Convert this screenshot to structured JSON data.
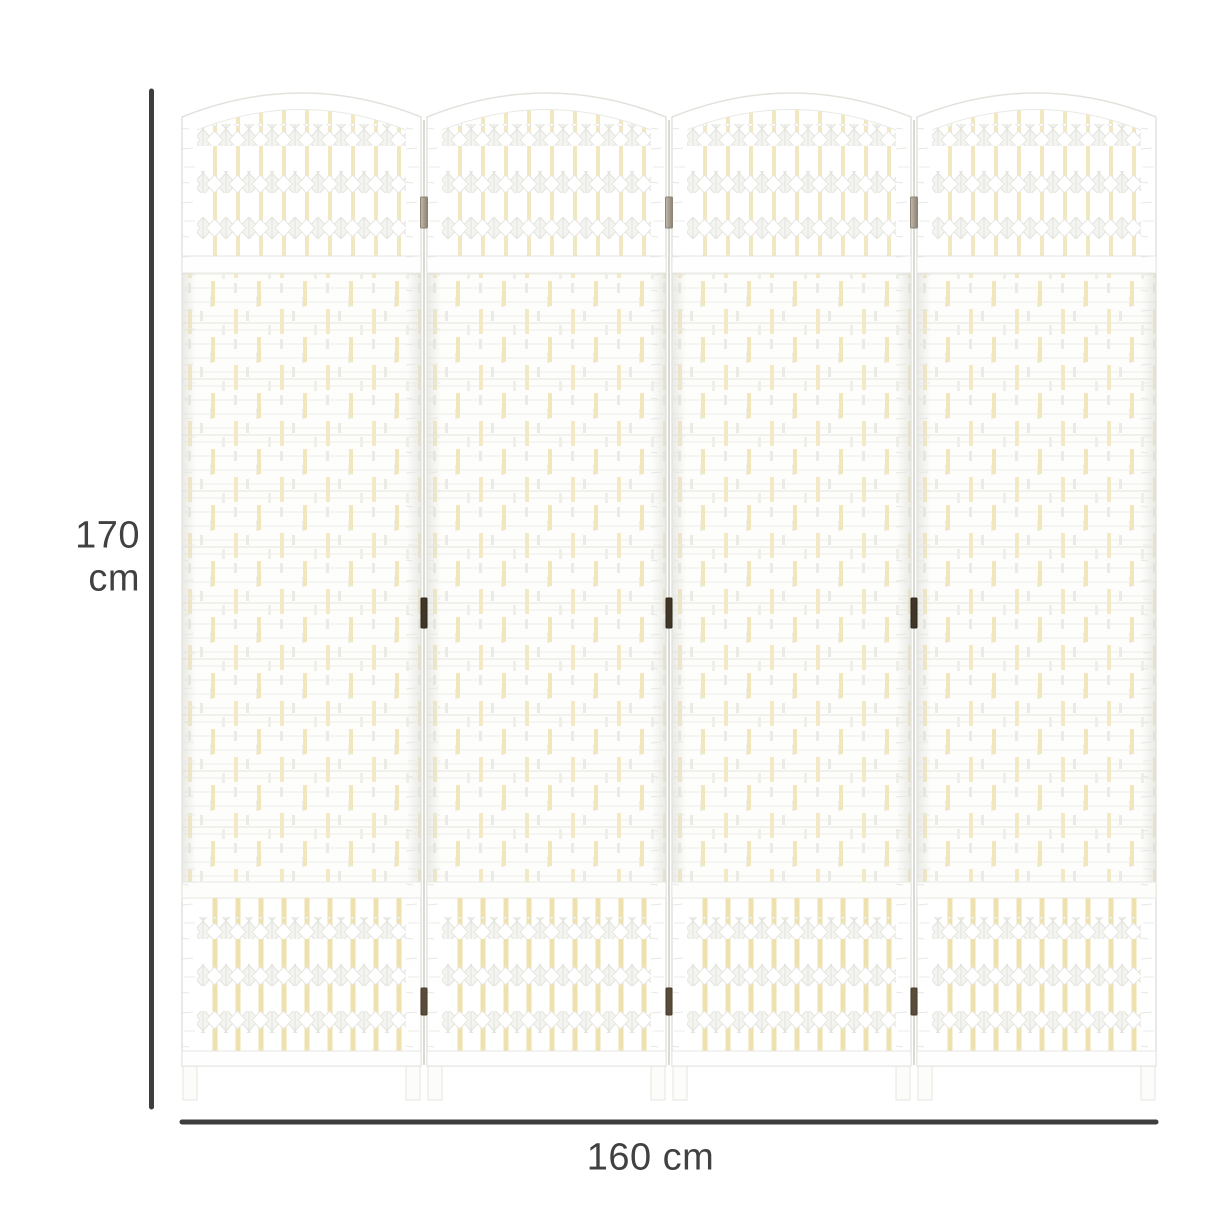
{
  "figure": {
    "description": "Four-panel wave-fiber folding room divider shown with overall dimension lines",
    "dimensions": {
      "height": "170 cm",
      "width": "160 cm"
    },
    "divider": {
      "panel_count": 4,
      "knot_rows_per_lattice": 3,
      "hinge_rows": 3
    },
    "colors": {
      "background": "#ffffff",
      "panel_white": "#ffffff",
      "weave_cream": "#f1e6bd",
      "frame_shadow": "#e4e4df",
      "dimension": "#3e3e3e",
      "hinge_light": "#a89e8f",
      "hinge_dark": "#3f3627",
      "hinge_bottom": "#5a4c3a"
    }
  }
}
